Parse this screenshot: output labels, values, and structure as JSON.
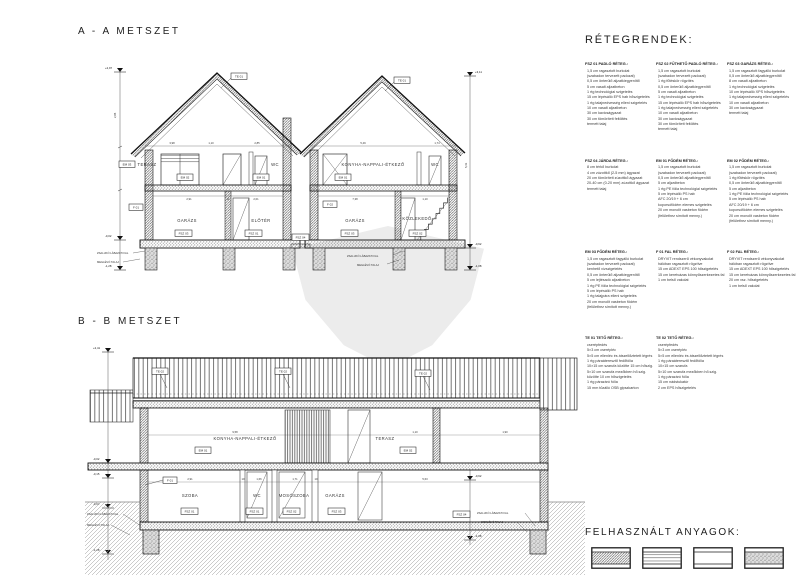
{
  "sections": {
    "aa": {
      "title": "A - A METSZET",
      "house1": {
        "upper": [
          "TERASZ",
          "WC"
        ],
        "lower": [
          "GARÁZS",
          "ELŐTÉR"
        ]
      },
      "house2": {
        "upper": [
          "KONYHA-NAPPALI-ÉTKEZŐ",
          "WC"
        ],
        "lower": [
          "GARÁZS",
          "KÖZLEKEDŐ"
        ]
      }
    },
    "bb": {
      "title": "B - B METSZET",
      "upper": [
        "KONYHA-NAPPALI-ÉTKEZŐ",
        "TERASZ"
      ],
      "lower": [
        "SZOBA",
        "WC",
        "MOSÓSZOBA",
        "GARÁZS"
      ]
    }
  },
  "tags": {
    "aa": {
      "roof_left": "TE 01",
      "roof_right": "TE 01",
      "terasz_tag": "EM 03",
      "slab_left": "EM 02",
      "wc1_tag": "EM 01",
      "slab_right": "EM 01",
      "wall_left": "F 01",
      "wall_mid": "F 02",
      "garazs1_floor": "FSZ 03",
      "eloter_floor": "FSZ 01",
      "jarda": "FSZ 04",
      "garazs2_floor": "FSZ 03",
      "kozlekedo_floor": "FSZ 02"
    },
    "bb": {
      "roof1": "TE 02",
      "roof2": "TE 02",
      "roof3": "TE 02",
      "slab_left": "EM 01",
      "slab_right": "EM 02",
      "wall_left": "F 01",
      "szoba_floor": "FSZ 01",
      "wc_floor": "FSZ 01",
      "moso_floor": "FSZ 02",
      "garazs_floor": "FSZ 03",
      "jarda": "FSZ 04"
    }
  },
  "annotations": {
    "zsaluko_fal": "ZSALUKŐ LÁBAZATI FAL",
    "meglevo_talaj": "MEGLÉVŐ TALAJ"
  },
  "elevations": {
    "aa_left": [
      "+2,97",
      "-0,02",
      "-1,28"
    ],
    "aa_right": [
      "+3,11",
      "-0,62",
      "-1,08"
    ],
    "bb_left": [
      "+2,41",
      "-0,02",
      "-0,15",
      "-0,62",
      "-1,28"
    ],
    "bb_right": [
      "-0,62",
      "-1,08"
    ]
  },
  "dims": {
    "aa": {
      "u1": [
        "3,98",
        "1,10",
        "2,85"
      ],
      "u2": [
        "5,49",
        "1,74"
      ],
      "l1": [
        "2,91",
        "11",
        "2,01"
      ],
      "l2": [
        "7,38",
        "1,10"
      ],
      "left_v": "2,85",
      "right_v": "5,41"
    },
    "bb": {
      "top": [
        "9,58",
        "1,10",
        "1,90"
      ],
      "low": [
        "2,91",
        "10",
        "1,66",
        "1,71",
        "10",
        "5,63"
      ],
      "left_v": "3,01"
    }
  },
  "legend": {
    "title": "RÉTEGRENDEK:",
    "blocks": [
      {
        "heading": "FSZ 01 PADLÓ RÉTEG.:",
        "lines": [
          "1,5 cm ragasztott burkolat",
          "(szabadon tervezett padozat)",
          "0,5 cm önterülő aljzatkiegyenlítő",
          "5 cm vasalt aljzatbeton",
          "1 rtg technológiai szigetelés",
          "15 cm lépésálló EPS hab hőszigetelés",
          "1 rtg talajnedvesség elleni szigetelés",
          "10 cm vasalt aljzatbeton",
          "30 cm kavicságyazat",
          "30 cm tömörített feltöltés",
          "termett talaj"
        ]
      },
      {
        "heading": "FSZ 02 FŰTHETŐ PADLÓ RÉTEG.:",
        "lines": [
          "1,5 cm ragasztott burkolat",
          "(szabadon tervezett padozat)",
          "1 rtg fűtéskör rögzítés",
          "0,5 cm önterülő aljzatkiegyenlítő",
          "5 cm vasalt aljzatbeton",
          "1 rtg technológiai szigetelés",
          "15 cm lépésálló EPS hab hőszigetelés",
          "1 rtg talajnedvesség elleni szigetelés",
          "10 cm vasalt aljzatbeton",
          "30 cm kavicságyazat",
          "30 cm tömörített feltöltés",
          "termett talaj"
        ]
      },
      {
        "heading": "FSZ 03 GARÁZS RÉTEG.:",
        "lines": [
          "1,5 cm ragasztott fagyálló burkolat",
          "0,5 cm önterülő aljzatkiegyenlítő",
          "8 cm vasalt aljzatbeton",
          "1 rtg technológiai szigetelés",
          "10 cm lépésálló XPS hőszigetelés",
          "1 rtg talajnedvesség elleni szigetelés",
          "10 cm vasalt aljzatbeton",
          "30 cm kavicságyazat",
          "termett talaj"
        ]
      },
      {
        "heading": "FSZ 04 JÁRDA RÉTEG.:",
        "lines": [
          "8 cm térkő burkolat",
          "4 cm zúzottkő (2-5 mm) ágyazat",
          "20 cm tömörített zúzottkő ágyazat",
          "20-40 cm (0-20 mm) zúzottkő ágyazat",
          "termett talaj"
        ]
      },
      {
        "heading": "EM 01 FÖDÉM RÉTEG.:",
        "lines": [
          "1,5 cm ragasztott burkolat",
          "(szabadon tervezett padozat)",
          "0,5 cm önterülő aljzatkiegyenlítő",
          "5 cm aljzatbeton",
          "1 rtg PE fólia technológiai szigetelés",
          "5 cm lépésálló PS hab",
          "AFC 20/19 + 6 cm",
          "koporsófödém elemes szigetelés",
          "20 cm monolit vasbeton födém",
          "(felülethez simított menny.)"
        ]
      },
      {
        "heading": "EM 02 FÖDÉM RÉTEG.:",
        "lines": [
          "1,5 cm ragasztott burkolat",
          "(szabadon tervezett padozat)",
          "1 rtg fűtéskör rögzítés",
          "0,5 cm önterülő aljzatkiegyenlítő",
          "5 cm aljzatbeton",
          "1 rtg PE fólia technológiai szigetelés",
          "5 cm lépésálló PS hab",
          "AFC 20/19 + 6 cm",
          "koporsófödém elemes szigetelés",
          "20 cm monolit vasbeton födém",
          "(felülethez simított menny.)"
        ]
      },
      {
        "heading": "EM 03 FÖDÉM RÉTEG.:",
        "lines": [
          "1,5 cm ragasztott fagyálló burkolat",
          "(szabadon tervezett padozat)",
          "kenhető vízszigetelés",
          "0,5 cm önterülő aljzatkiegyenlítő",
          "5 cm lejtésadó aljzatbeton",
          "1 rtg PE fólia technológiai szigetelés",
          "5 cm lépésálló PS hab",
          "1 rtg talajpára elleni szigetelés",
          "20 cm monolit vasbeton födém",
          "(felülethez simított menny.)"
        ]
      },
      {
        "heading": "F 01 FAL RÉTEG.:",
        "lines": [
          "DRYVIT rendszerű vékonyvakolat",
          "hálóban ragasztott rögzítve",
          "15 cm ADEXT EPS 100 hőszigetelés",
          "15 cm keretvázas könnyűszerkezetes fal",
          "1 cm belső vakolat"
        ]
      },
      {
        "heading": "F 02 FAL RÉTEG.:",
        "lines": [
          "DRYVIT rendszerű vékonyvakolat",
          "hálóban ragasztott rögzítve",
          "15 cm ADEXT EPS 100 hőszigetelés",
          "15 cm keretvázas könnyűszerkezetes fal",
          "20 cm vsz. hőszigetelés",
          "1 cm belső vakolat"
        ]
      },
      {
        "heading": "TE 01 TETŐ RÉTEG.:",
        "lines": [
          "cserépfedés",
          "5×3 cm cserépléc",
          "5×5 cm ellenléc és átszellőztetett légrés",
          "1 rtg páraáteresztő fedőfólia",
          "10×15 cm szarufa közötte 15 cm hőszig.",
          "5×10 cm szarufa mezőkben hő.szig.",
          "közötte 10 cm hőszigetelés",
          "1 rtg párazáró fólia",
          "15 mm tűzálló OSB gipszkarton"
        ]
      },
      {
        "heading": "TE 02 TETŐ RÉTEG.:",
        "lines": [
          "cserépfedés",
          "5×3 cm cserépléc",
          "5×5 cm ellenléc és átszellőztetett légrés",
          "1 rtg páraáteresztő fedőfólia",
          "10×15 cm szarufa",
          "5×10 cm szarufa mezőkben hő.szig.",
          "1 rtg párazáró fólia",
          "15 cm nádstukatúr",
          "2 cm EPS hőszigetelés"
        ]
      }
    ]
  },
  "materials": {
    "title": "FELHASZNÁLT ANYAGOK:",
    "items": [
      {
        "label": "TÉGLA FAL",
        "pattern": "brick"
      },
      {
        "label": "FA SZERKEZET",
        "pattern": "wood"
      },
      {
        "label": "HŐSZIGETELÉS",
        "pattern": "insulation"
      },
      {
        "label": "VASBETON",
        "pattern": "concrete"
      }
    ]
  }
}
